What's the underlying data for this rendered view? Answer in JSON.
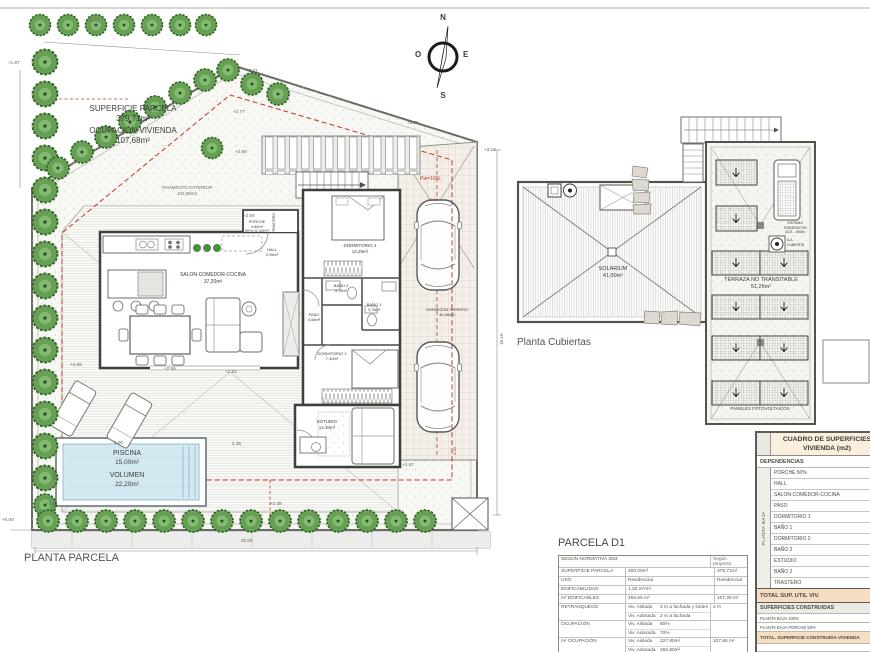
{
  "site": {
    "title": "PLANTA PARCELA",
    "superficie_label": "SUPERFICIE PARCELA",
    "superficie_value": "379,71m²",
    "ocupacion_label": "OCUPACIÓN VIVIENDA",
    "ocupacion_value": "107,68m²",
    "pavimento_label": "PAVIMENTO EXTERIOR",
    "pavimento_value": "102,06m2",
    "piscina_label": "PISCINA",
    "piscina_value": "15,00m²",
    "volumen_label": "VOLUMEN",
    "volumen_value": "22,20m²",
    "rooms": {
      "salon": {
        "label": "SALON-COMEDOR-COCINA",
        "value": "37,20m²"
      },
      "hall": {
        "label": "HALL",
        "value": "2,06m²"
      },
      "porche": {
        "label": "PORCHE",
        "value": "4,80m²",
        "extra": "50%=(2,40m²)"
      },
      "paso": {
        "label": "PASO",
        "value": "4,66m²"
      },
      "dormitorio1": {
        "label": "DORMITORIO 1",
        "value": "12,25m²"
      },
      "bano2": {
        "label": "BAÑO 2",
        "value": "3,75m²"
      },
      "bano1": {
        "label": "BAÑO 1",
        "value": "3,76m²"
      },
      "dormitorio2": {
        "label": "DORMITORIO 2",
        "value": "7,40m²"
      },
      "estudio": {
        "label": "ESTUDIO",
        "value": "14,30m²"
      },
      "trastero": {
        "label": "TRASTERO"
      }
    },
    "garage": {
      "label": "HORMIGÓN IMPRESO",
      "value": "40,06m2",
      "slope": "Pte=16%"
    },
    "dims": {
      "a": "+2.53",
      "b": "+1.87",
      "c": "+2.77",
      "d": "+2.59",
      "e": "+3.05",
      "f": "+3.13",
      "g": "+2.58",
      "h": "+2.99",
      "i": "+2.64",
      "j": "+2.57",
      "k": "+2.51",
      "l": "+2.38",
      "m": "+0.00",
      "n": "20.00",
      "o": "16.15",
      "p": "6.00",
      "q": "4.36",
      "r": "3.00",
      "s": "+0.67",
      "t": "2.00"
    }
  },
  "compass": {
    "n": "N",
    "s": "S",
    "e": "E",
    "o": "O"
  },
  "roof": {
    "title": "Planta Cubiertas",
    "solarium_label": "SOLARIUM",
    "solarium_value": "41,00m²",
    "terraza_label": "TERRAZA NO TRANSITABLE",
    "terraza_value": "51,26m²",
    "paneles_label": "PANELES  FOTOVOLTAICOS",
    "termosifon_1": "SISTEMA",
    "termosifon_2": "TERMOSIFON",
    "termosifon_3": "ACS - 150lts",
    "aa_1": "A.A.",
    "aa_2": "CUBIERTA"
  },
  "parcela_table": {
    "title": "PARCELA D1",
    "col_normativa": "SEGUN NORMATIVA 3/53",
    "col_proyecto": "Según proyecto",
    "rows": [
      {
        "label": "SUPERFICIE PARCELA",
        "value": "200,00m²",
        "proyecto": "379,71m²"
      },
      {
        "label": "USO",
        "value": "Residencial",
        "proyecto": "Residencial"
      },
      {
        "label": "EDIFICABILIDAD",
        "value": "1,20 m²/m²",
        "proyecto": ""
      },
      {
        "label": "m² EDIFICABLES",
        "value": "455,65 m²",
        "proyecto": "107,28 m²"
      },
      {
        "label": "RETRANQUEOS",
        "sub1": "Viv. Aislada",
        "val1": "2 m a fachada y lindes",
        "sub2": "Viv. Adosada",
        "val2": "2 m a fachada",
        "proyecto": "2 m"
      },
      {
        "label": "OCUPACIÓN",
        "sub1": "Viv. Aislada",
        "val1": "60%",
        "sub2": "Viv. Adosada",
        "val2": "70%",
        "proyecto": ""
      },
      {
        "label": "m² OCUPACIÓN",
        "sub1": "Viv. Aislada",
        "val1": "227,80m²",
        "sub2": "Viv. Adosada",
        "val2": "265,80m²",
        "proyecto": "107,68 m²"
      }
    ]
  },
  "cuadro_table": {
    "title_1": "CUADRO DE SUPERFICIES",
    "title_2": "VIVIENDA (m2)",
    "dependencias": "DEPENDENCIAS",
    "planta_baja": "PLANTA BAJA",
    "rooms": [
      "PORCHE 50%",
      "HALL",
      "SALON-COMEDOR-COCINA",
      "PASO",
      "DORMITORIO 1",
      "BAÑO 1",
      "DORMITORIO 2",
      "BAÑO 2",
      "ESTUDIO",
      "BAÑO 2",
      "TRASTERO"
    ],
    "total_util": "TOTAL SUP. UTIL VIV.",
    "construidas_header": "SUPERFICIES CONSTRUIDAS",
    "construidas_rows": [
      "PLANTA BAJA 100%",
      "PLANTA BAJA PORCHE 50%"
    ],
    "total_construida": "TOTAL. SUPERFICIE CONSTRUIDA VIVIENDA",
    "agua_rows": [
      "SUPERFICIE LAMINA DE AGUA - PISCINA",
      "VOLUMEN DE AGUA, PISCINA"
    ]
  }
}
